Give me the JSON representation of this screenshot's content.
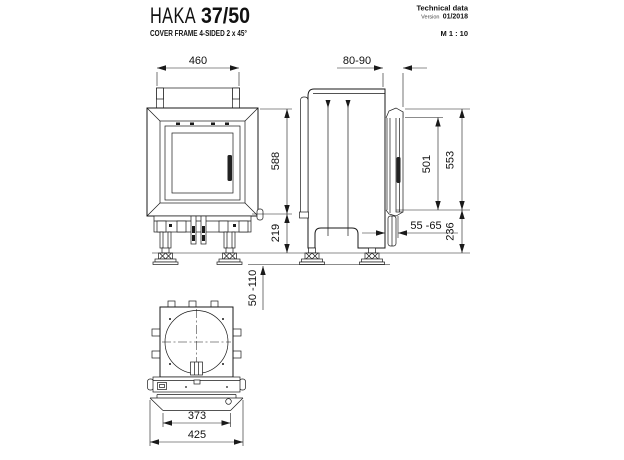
{
  "header": {
    "model": "HAKA",
    "size": "37/50",
    "subtitle": "COVER FRAME 4-SIDED 2 x 45°",
    "tech_label": "Technical data",
    "version_label": "Version",
    "version_value": "01/2018",
    "scale": "M 1 : 10"
  },
  "dims": {
    "front_width": "460",
    "frame_height": "588",
    "base_height": "219",
    "foot_range": "50 -110",
    "depth_range": "80-90",
    "door_height": "501",
    "side_height": "553",
    "side_base": "236",
    "frame_depth_range": "55 -65",
    "inner_width": "373",
    "outer_width": "425"
  },
  "colors": {
    "line": "#1a1a1a",
    "background": "#ffffff"
  }
}
